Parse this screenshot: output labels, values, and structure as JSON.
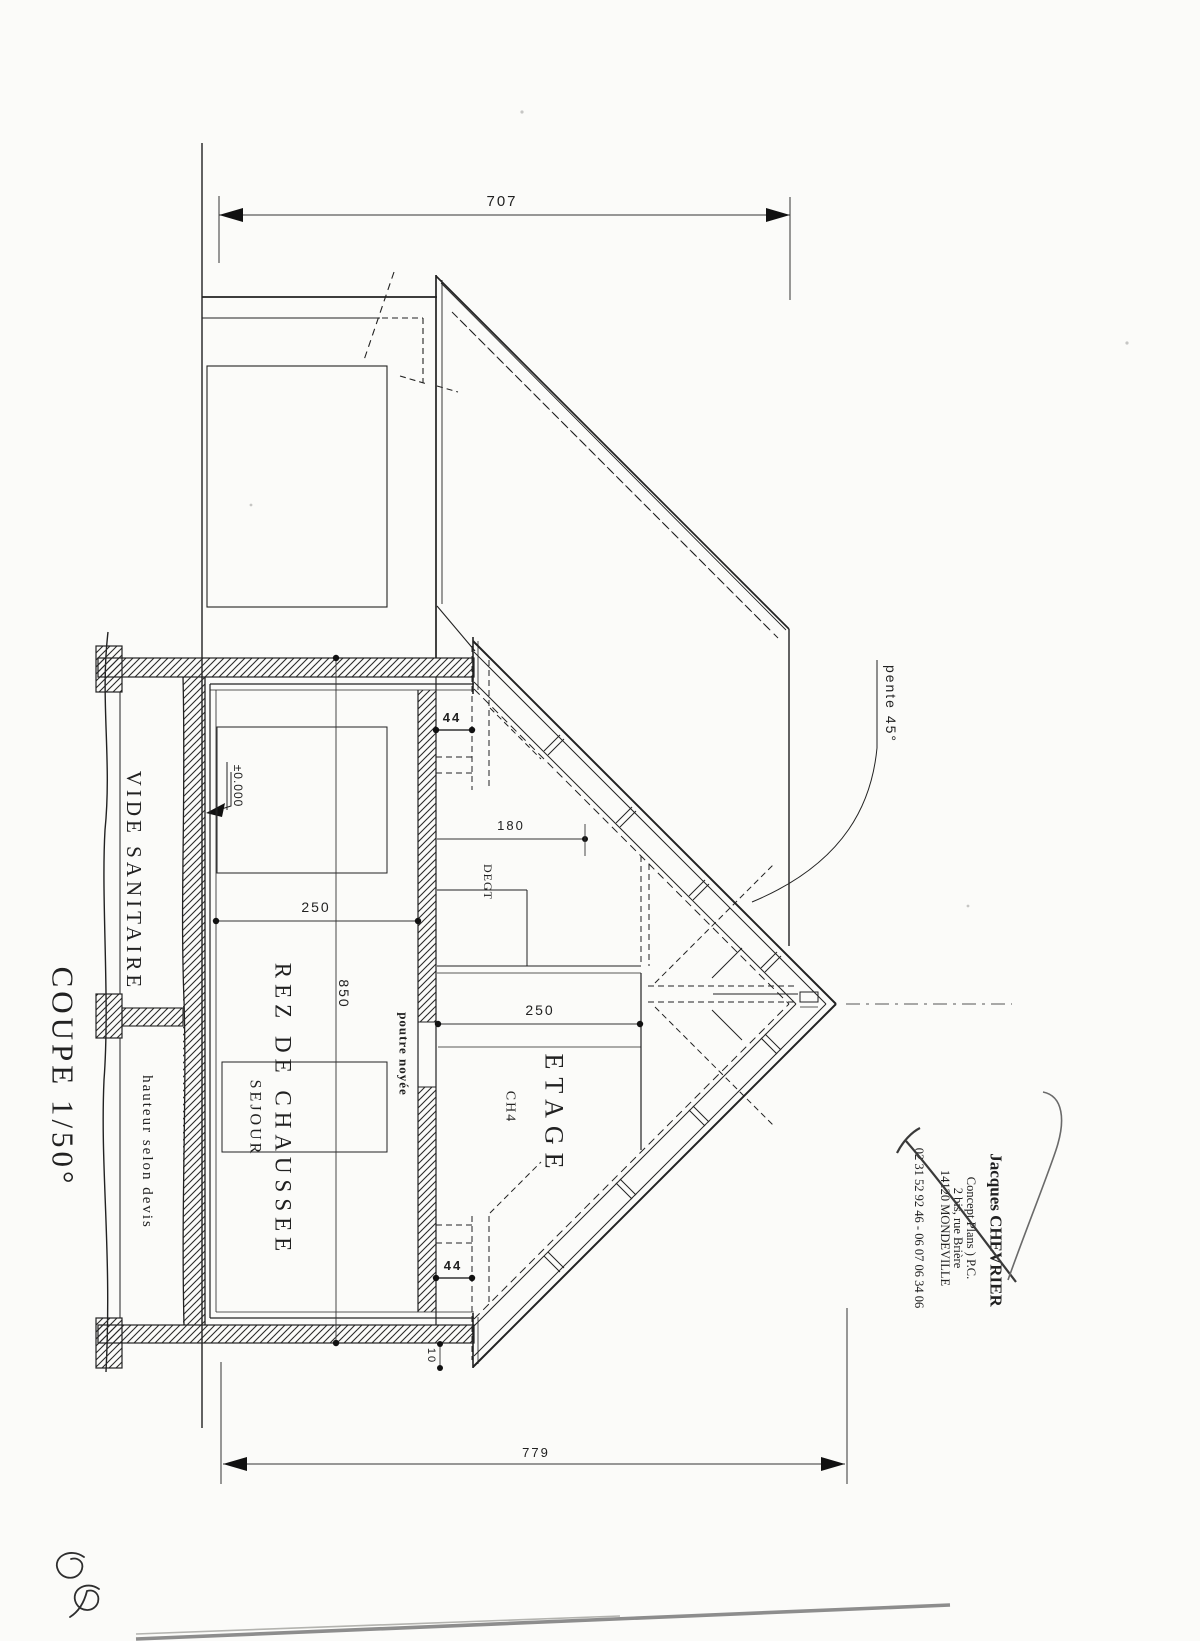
{
  "page": {
    "background": "#fbfbf9",
    "ink_color": "#212121",
    "ground_line_color": "#8d8d8d"
  },
  "title": {
    "scale_label": "COUPE 1/50°"
  },
  "rooms": {
    "crawl_space": "VIDE SANITAIRE",
    "crawl_height_note": "hauteur selon devis",
    "ground_floor": "REZ DE CHAUSSEE",
    "living_room": "SEJOUR",
    "upper_floor": "ETAGE",
    "bedroom4": "CH4",
    "hallway": "DEGT"
  },
  "annotations": {
    "level_mark": "±0.000",
    "roof_slope": "pente 45°",
    "embedded_beam": "poutre noyée"
  },
  "dimensions": {
    "overall_top": "707",
    "overall_bottom": "779",
    "wall_height": "850",
    "ground_floor_height": "250",
    "upper_floor_height": "250",
    "headroom": "180",
    "knee_wall_top": "44",
    "knee_wall_bottom": "44",
    "eave_offset": "10"
  },
  "title_block": {
    "author": "Jacques CHEVRIER",
    "line2": "Concept Plans ) P.C.",
    "line3": "2 bis, rue Brière",
    "line4": "14120 MONDEVILLE",
    "line5": "02 31 52 92 46 - 06 07 06 34 06"
  }
}
